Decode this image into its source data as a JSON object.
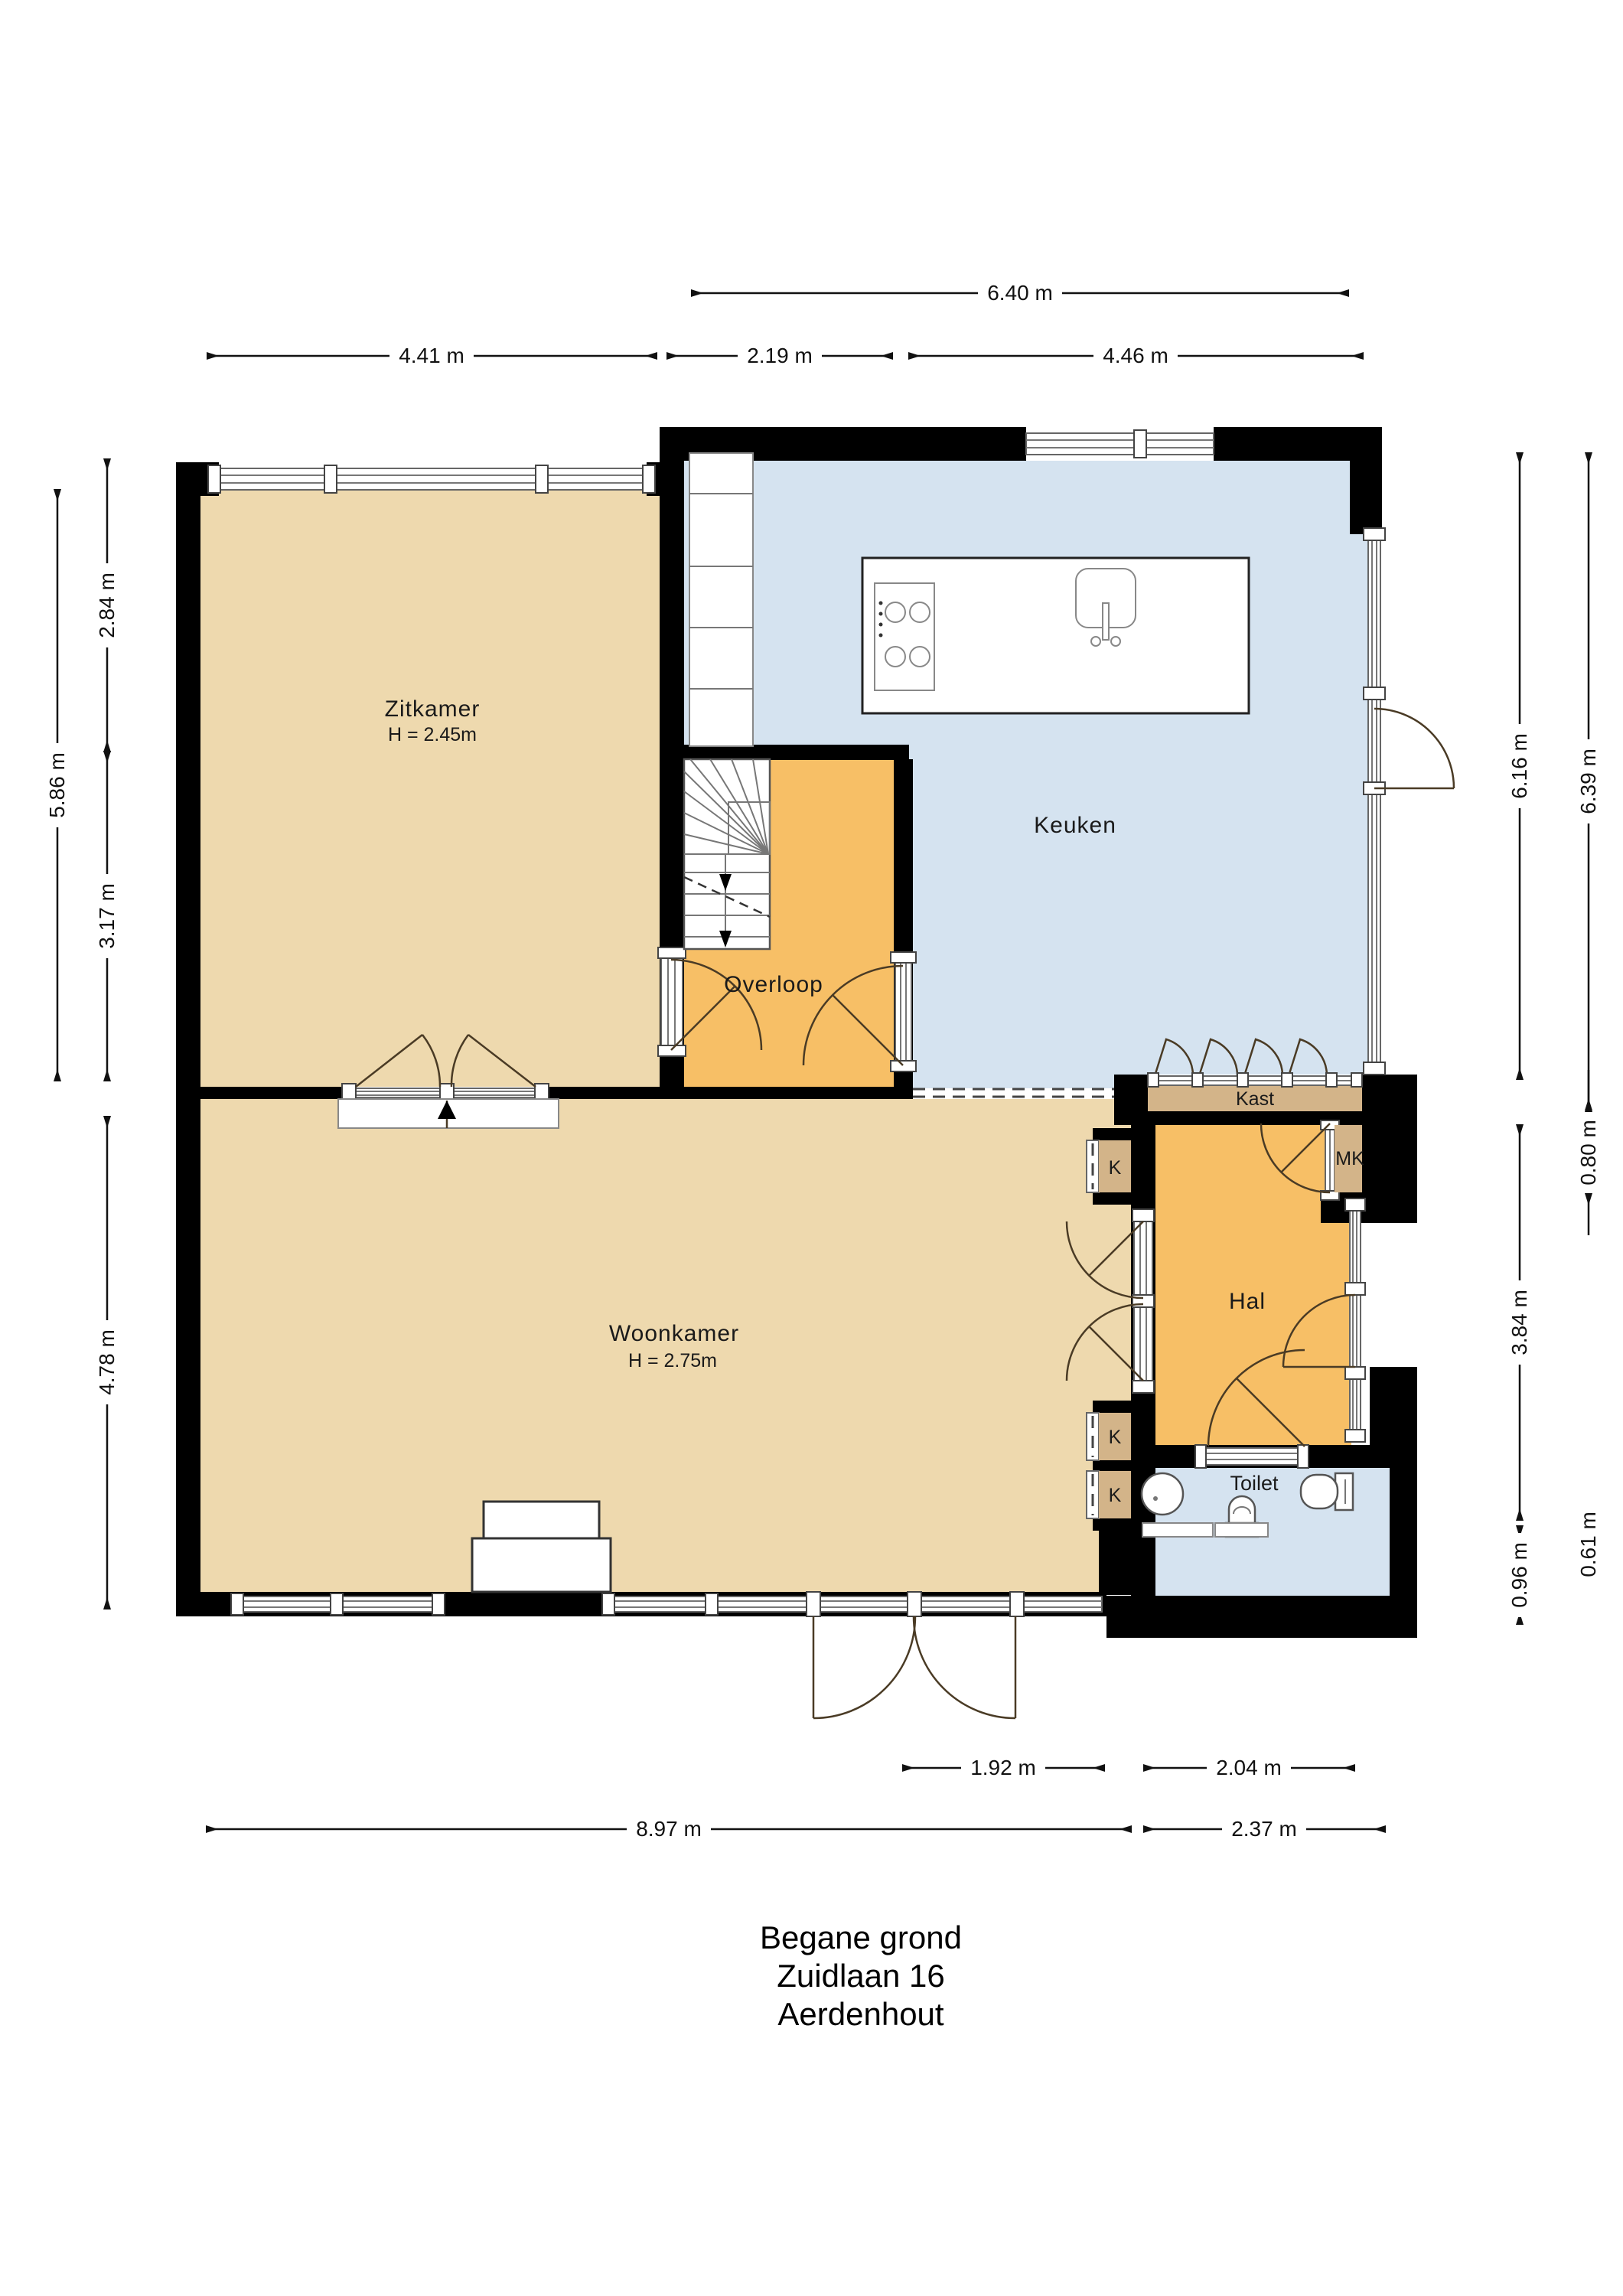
{
  "title": {
    "floor": "Begane grond",
    "street": "Zuidlaan 16",
    "city": "Aerdenhout"
  },
  "rooms": {
    "zitkamer": {
      "label": "Zitkamer",
      "ceiling": "H = 2.45m"
    },
    "keuken": {
      "label": "Keuken"
    },
    "overloop": {
      "label": "Overloop"
    },
    "woonkamer": {
      "label": "Woonkamer",
      "ceiling": "H = 2.75m"
    },
    "hal": {
      "label": "Hal"
    },
    "kast": {
      "label": "Kast"
    },
    "meterkast": {
      "label": "MK"
    },
    "toilet": {
      "label": "Toilet"
    },
    "closet1": {
      "label": "K"
    },
    "closet2": {
      "label": "K"
    },
    "closet3": {
      "label": "K"
    }
  },
  "dimensions": {
    "top_total": "6.40 m",
    "top_zitkamer": "4.41 m",
    "top_overloop": "2.19 m",
    "top_keuken": "4.46 m",
    "left_total": "5.86 m",
    "left_upper": "2.84 m",
    "left_lower": "3.17 m",
    "left_woonkamer": "4.78 m",
    "right_keuken_inner": "6.16 m",
    "right_keuken_outer": "6.39 m",
    "right_kast": "0.80 m",
    "right_hal": "3.84 m",
    "right_toilet": "0.96 m",
    "right_offset": "0.61 m",
    "bottom_door": "1.92 m",
    "bottom_toilet": "2.04 m",
    "bottom_total": "8.97 m",
    "bottom_right": "2.37 m"
  },
  "colors": {
    "floor_tan": "#eed9ae",
    "floor_orange": "#f7bf66",
    "floor_blue": "#d5e3f0",
    "closet_tan": "#d3b489",
    "wall": "#000000"
  }
}
